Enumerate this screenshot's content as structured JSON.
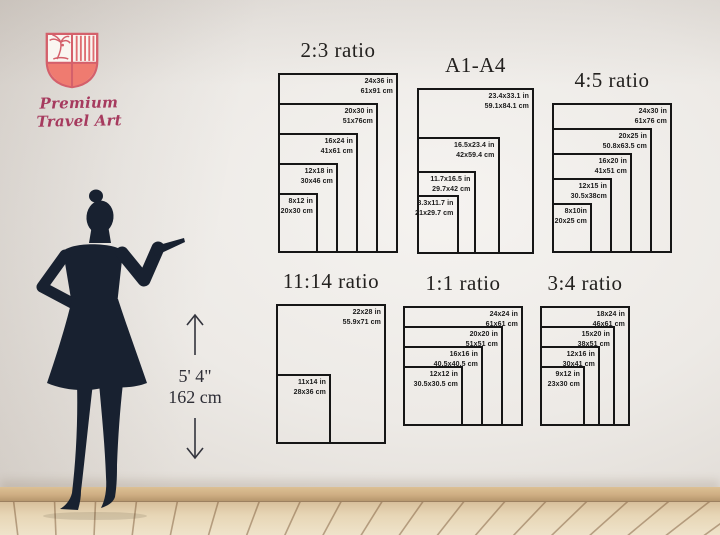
{
  "brand": {
    "name": "Premium Travel Art"
  },
  "figure": {
    "height_imperial": "5' 4\"",
    "height_metric": "162 cm"
  },
  "palette": {
    "brand_pink": "#a63a5e",
    "shield_salmon": "#ef7b70",
    "shield_outline": "#d4606b",
    "frame_border": "#161616",
    "silhouette_navy": "#182130",
    "baseboard_wood": "#cfae83",
    "floor_wood": "#e7d6b6"
  },
  "diagrams": [
    {
      "id": "ratio-2-3",
      "title": "2:3 ratio",
      "sizes": [
        {
          "in": "24x36 in",
          "cm": "61x91 cm",
          "w": 24,
          "h": 36
        },
        {
          "in": "20x30 in",
          "cm": "51x76cm",
          "w": 20,
          "h": 30
        },
        {
          "in": "16x24 in",
          "cm": "41x61 cm",
          "w": 16,
          "h": 24
        },
        {
          "in": "12x18 in",
          "cm": "30x46 cm",
          "w": 12,
          "h": 18
        },
        {
          "in": "8x12 in",
          "cm": "20x30 cm",
          "w": 8,
          "h": 12
        }
      ]
    },
    {
      "id": "a1-a4",
      "title": "A1-A4",
      "sizes": [
        {
          "in": "23.4x33.1 in",
          "cm": "59.1x84.1 cm",
          "w": 23.4,
          "h": 33.1
        },
        {
          "in": "16.5x23.4 in",
          "cm": "42x59.4 cm",
          "w": 16.5,
          "h": 23.4
        },
        {
          "in": "11.7x16.5 in",
          "cm": "29.7x42 cm",
          "w": 11.7,
          "h": 16.5
        },
        {
          "in": "8.3x11.7 in",
          "cm": "21x29.7 cm",
          "w": 8.3,
          "h": 11.7
        }
      ]
    },
    {
      "id": "ratio-4-5",
      "title": "4:5 ratio",
      "sizes": [
        {
          "in": "24x30 in",
          "cm": "61x76 cm",
          "w": 24,
          "h": 30
        },
        {
          "in": "20x25 in",
          "cm": "50.8x63.5 cm",
          "w": 20,
          "h": 25
        },
        {
          "in": "16x20 in",
          "cm": "41x51 cm",
          "w": 16,
          "h": 20
        },
        {
          "in": "12x15 in",
          "cm": "30.5x38cm",
          "w": 12,
          "h": 15
        },
        {
          "in": "8x10in",
          "cm": "20x25 cm",
          "w": 8,
          "h": 10
        }
      ]
    },
    {
      "id": "ratio-11-14",
      "title": "11:14 ratio",
      "sizes": [
        {
          "in": "22x28 in",
          "cm": "55.9x71 cm",
          "w": 22,
          "h": 28
        },
        {
          "in": "11x14 in",
          "cm": "28x36 cm",
          "w": 11,
          "h": 14
        }
      ]
    },
    {
      "id": "ratio-1-1",
      "title": "1:1 ratio",
      "sizes": [
        {
          "in": "24x24 in",
          "cm": "61x61 cm",
          "w": 24,
          "h": 24
        },
        {
          "in": "20x20 in",
          "cm": "51x51 cm",
          "w": 20,
          "h": 20
        },
        {
          "in": "16x16 in",
          "cm": "40.5x40.5 cm",
          "w": 16,
          "h": 16
        },
        {
          "in": "12x12 in",
          "cm": "30.5x30.5 cm",
          "w": 12,
          "h": 12
        }
      ]
    },
    {
      "id": "ratio-3-4",
      "title": "3:4 ratio",
      "sizes": [
        {
          "in": "18x24 in",
          "cm": "46x61 cm",
          "w": 18,
          "h": 24
        },
        {
          "in": "15x20 in",
          "cm": "38x51 cm",
          "w": 15,
          "h": 20
        },
        {
          "in": "12x16 in",
          "cm": "30x41 cm",
          "w": 12,
          "h": 16
        },
        {
          "in": "9x12 in",
          "cm": "23x30 cm",
          "w": 9,
          "h": 12
        }
      ]
    }
  ]
}
